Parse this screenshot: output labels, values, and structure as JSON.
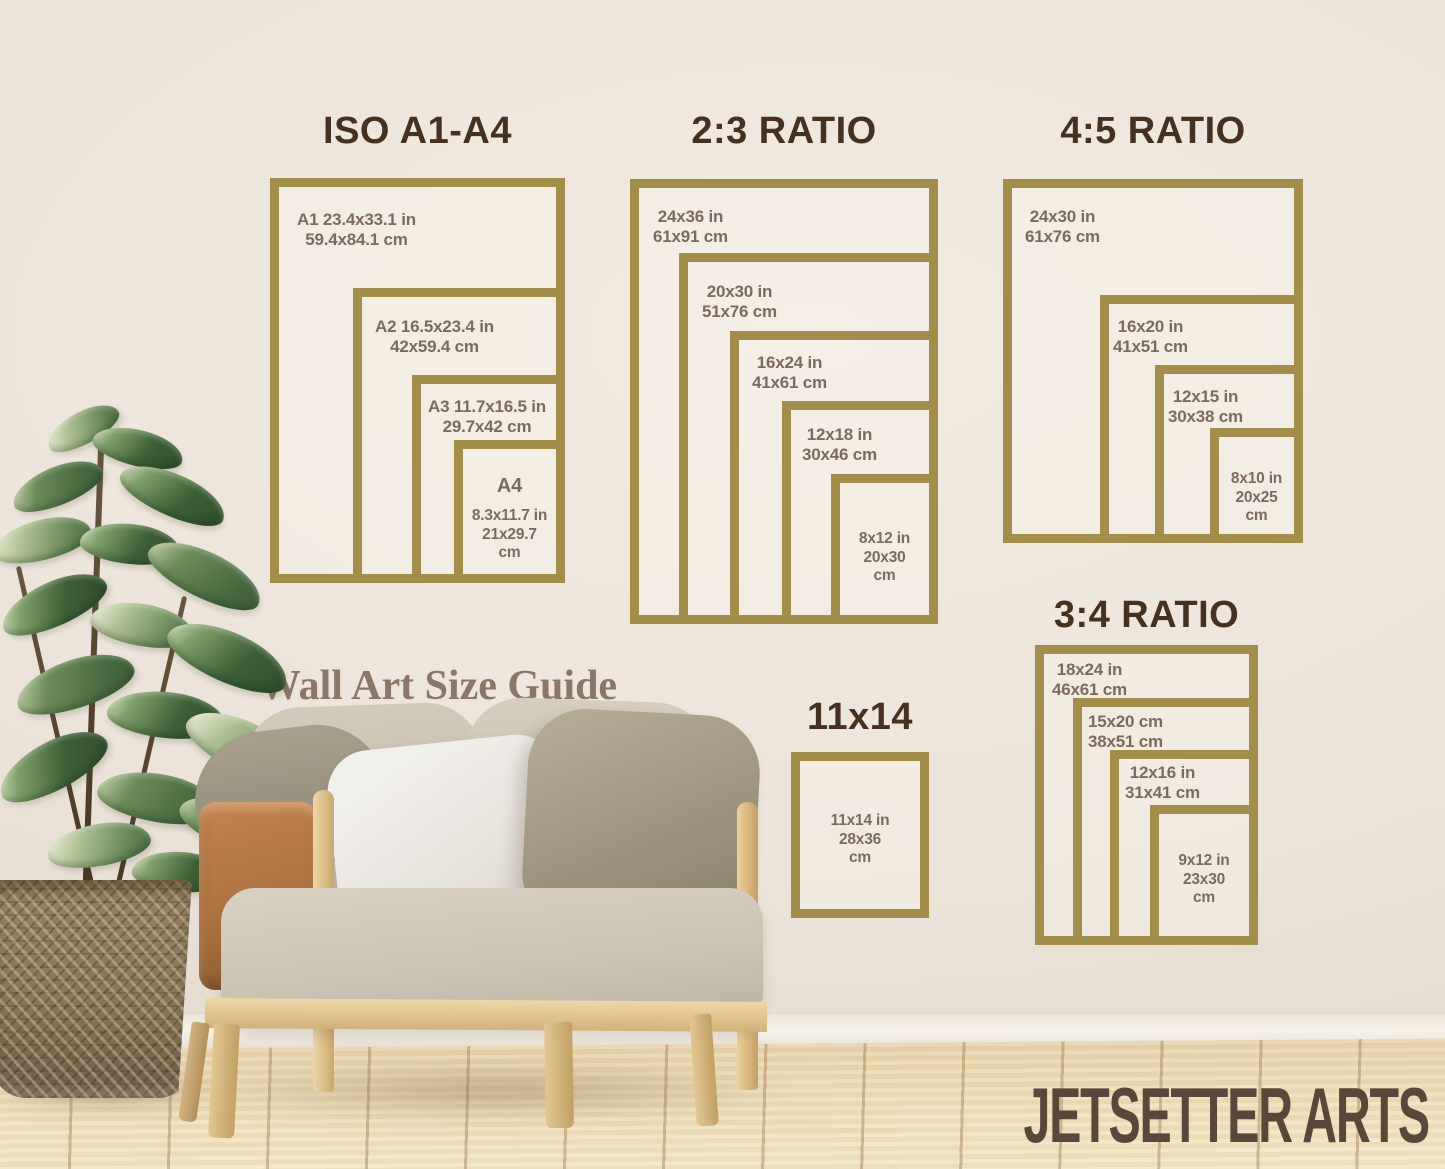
{
  "heading": {
    "text": "Wall Art Size Guide"
  },
  "brand": {
    "text": "JETSETTER ARTS"
  },
  "colors": {
    "frame_gold": "#a28d4b",
    "title_brown": "#46301f",
    "label_brown": "#7c6b5d",
    "heading_brown": "#8b7668",
    "brand_brown": "#5b473a"
  },
  "groups": [
    {
      "title": "ISO A1-A4",
      "frames": [
        {
          "name": "A1",
          "lines": [
            "A1 23.4x33.1 in",
            "59.4x84.1 cm"
          ]
        },
        {
          "name": "A2",
          "lines": [
            "A2 16.5x23.4 in",
            "42x59.4 cm"
          ]
        },
        {
          "name": "A3",
          "lines": [
            "A3 11.7x16.5 in",
            "29.7x42 cm"
          ]
        },
        {
          "name": "A4",
          "head": "A4",
          "lines": [
            "8.3x11.7 in",
            "21x29.7",
            "cm"
          ]
        }
      ]
    },
    {
      "title": "2:3 RATIO",
      "frames": [
        {
          "name": "24x36",
          "lines": [
            "24x36 in",
            "61x91 cm"
          ]
        },
        {
          "name": "20x30",
          "lines": [
            "20x30 in",
            "51x76 cm"
          ]
        },
        {
          "name": "16x24",
          "lines": [
            "16x24 in",
            "41x61 cm"
          ]
        },
        {
          "name": "12x18",
          "lines": [
            "12x18 in",
            "30x46 cm"
          ]
        },
        {
          "name": "8x12",
          "lines": [
            "8x12 in",
            "20x30",
            "cm"
          ]
        }
      ]
    },
    {
      "title": "4:5 RATIO",
      "frames": [
        {
          "name": "24x30",
          "lines": [
            "24x30 in",
            "61x76 cm"
          ]
        },
        {
          "name": "16x20",
          "lines": [
            "16x20 in",
            "41x51 cm"
          ]
        },
        {
          "name": "12x15",
          "lines": [
            "12x15 in",
            "30x38 cm"
          ]
        },
        {
          "name": "8x10",
          "lines": [
            "8x10 in",
            "20x25",
            "cm"
          ]
        }
      ]
    },
    {
      "title": "3:4 RATIO",
      "frames": [
        {
          "name": "18x24",
          "lines": [
            "18x24 in",
            "46x61 cm"
          ]
        },
        {
          "name": "15x20",
          "lines": [
            "15x20 cm",
            "38x51 cm"
          ]
        },
        {
          "name": "12x16",
          "lines": [
            "12x16 in",
            "31x41 cm"
          ]
        },
        {
          "name": "9x12",
          "lines": [
            "9x12 in",
            "23x30",
            "cm"
          ]
        }
      ]
    },
    {
      "title": "11x14",
      "frames": [
        {
          "name": "11x14",
          "lines": [
            "11x14 in",
            "28x36",
            "cm"
          ]
        }
      ]
    }
  ]
}
